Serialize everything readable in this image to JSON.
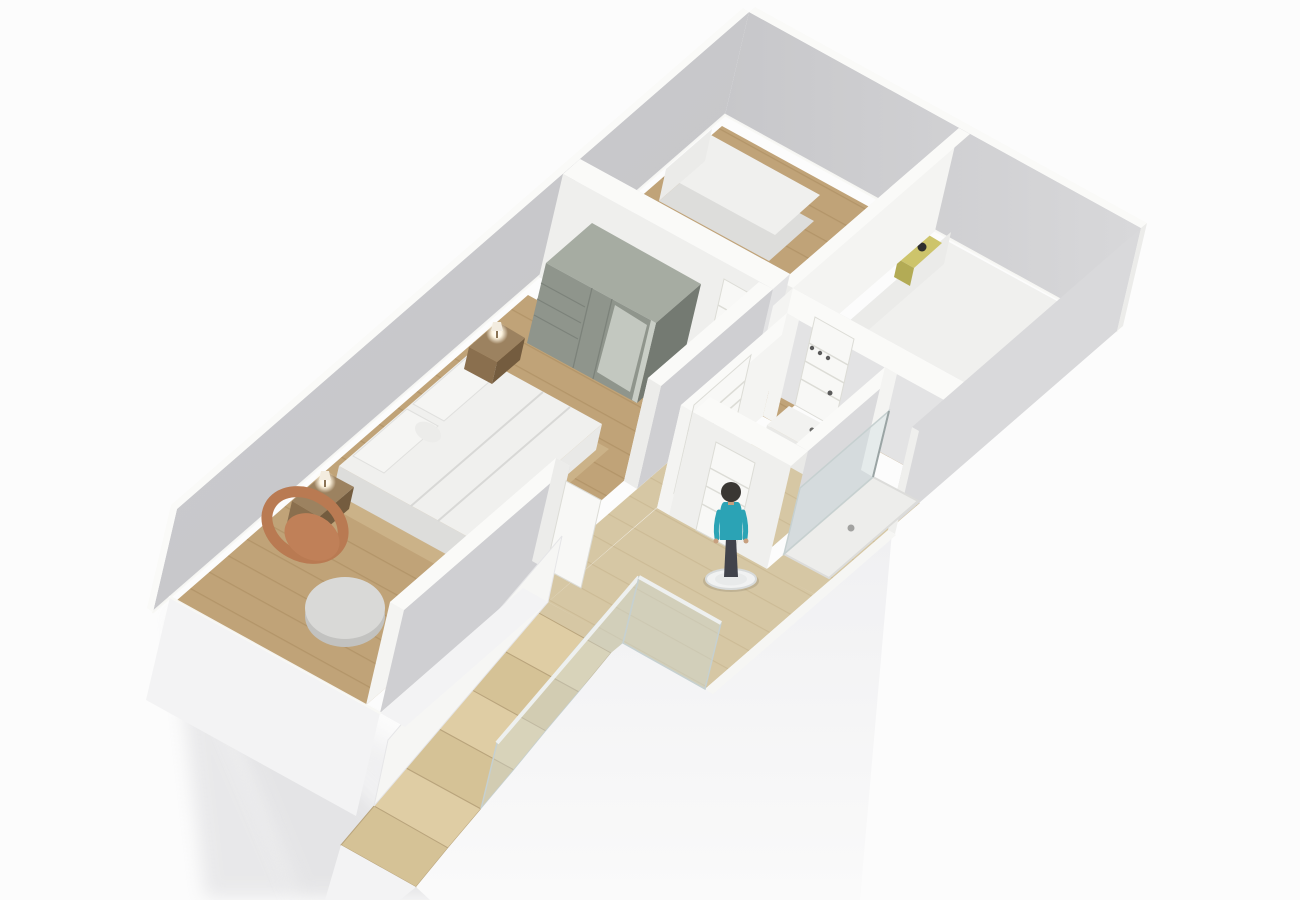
{
  "meta": {
    "description": "3D isometric rendering of an upper-floor apartment plan with three bedrooms, a bathroom with shower, a landing with a standing person figure, and a wooden staircase descending to the lower floor"
  },
  "palette": {
    "bg": "#fcfcfc",
    "shadow1": "#d2d2d5",
    "shadow2": "#dddde0",
    "wallNW1": "#c3c3c6",
    "wallNW2": "#d2d2d5",
    "wallNE1": "#c7c7ca",
    "wallNE2": "#d8d8da",
    "wallSE": "#d9d9db",
    "wallTop": "#fafaf8",
    "wallBright": "#f4f4f2",
    "wallInnerGray": "#cfcfd2",
    "wallSouth": "#efefed",
    "wallNorthFace": "#e3e3e4",
    "wallCap": "#ececea",
    "junction": "#f8f8f4",
    "wood": "#c0a378",
    "woodLine": "#a8895c",
    "woodLight": "#d6c7a4",
    "woodLightLine": "#c1b088",
    "stairTread": "#dfcda4",
    "stairTread2": "#d5c296",
    "stairEdge": "#b9a47c",
    "matTop": "#f0f0ee",
    "matSide": "#dddddb",
    "frameWood": "#cbb288",
    "headboard": "#ebebe9",
    "duvetLine": "#d8d8d6",
    "pillow": "#f5f5f3",
    "wardrobeFront": "#8f958c",
    "wardrobeSide": "#747a72",
    "wardrobeTop": "#a6aca2",
    "wardrobeMirror": "#c3c8c0",
    "wardrobeShelf": "#c9cec6",
    "wardrobeLine": "#7c827a",
    "nightstand": "#8a6f4e",
    "nightstandSide": "#745c3f",
    "nightstandTop": "#9c8260",
    "lampGlow": "#fdf4e0",
    "lampShade": "#f3ecdf",
    "lampStem": "#8a7355",
    "chair": "#b97a52",
    "chairSeat": "#c08058",
    "ottoman": "#d9d9d7",
    "ottomanShade": "#c2c2c0",
    "yellowStand": "#cdc46b",
    "darkLamp": "#2e2e2e",
    "door": "#f8f8f6",
    "doorLine": "#dcdcd6",
    "handle": "#5a5a5a",
    "glass": "rgba(205,220,223,0.38)",
    "glassEdge": "#c6d0d0",
    "rail": "#f0f2f2",
    "tray": "#ededeb",
    "trayEdge": "#dcdcda",
    "drain": "#a2a2a0",
    "vanity": "#f2f2f0",
    "vanityFront": "#e9e9e7",
    "personShirt": "#2ba3b5",
    "personPants": "#41434b",
    "personHair": "#3a3733",
    "personSkin": "#c79f7e",
    "disc": "#f1f2f2",
    "discEdge": "#d8dbdb",
    "discInner": "#e8eaea",
    "slab": "#f3f3f4",
    "slabEdge": "#e6e6e8",
    "fascia": "#f6f6f4",
    "hook": "#4a4a4a"
  },
  "scene": {
    "view": "isometric-3d-floorplan",
    "rooms": [
      {
        "name": "master-bedroom",
        "floor": "wood",
        "furniture": [
          "double-bed",
          "pillows",
          "nightstand-left",
          "nightstand-right",
          "table-lamp-left",
          "table-lamp-right",
          "wardrobe",
          "armchair",
          "ottoman"
        ]
      },
      {
        "name": "twin-bedroom",
        "floor": "wood",
        "furniture": [
          "single-bed-1",
          "single-bed-2"
        ]
      },
      {
        "name": "right-bedroom",
        "floor": "wood",
        "furniture": [
          "double-bed",
          "yellow-nightstand",
          "black-lamp"
        ]
      },
      {
        "name": "bathroom",
        "floor": "light-wood",
        "furniture": [
          "vanity",
          "shower-tray",
          "glass-screen",
          "wall-hooks"
        ]
      },
      {
        "name": "landing",
        "floor": "light-wood",
        "furniture": [
          "person-figure",
          "glass-balustrade"
        ]
      },
      {
        "name": "staircase",
        "floor": "light-wood",
        "steps_visible": 7,
        "direction": "descending-to-lower-left"
      }
    ],
    "person": {
      "shirt_color": "teal",
      "pose": "standing",
      "base": "white-disc"
    },
    "doors_visible": 5,
    "lighting": "soft daylight, shadows cast to lower-left"
  }
}
